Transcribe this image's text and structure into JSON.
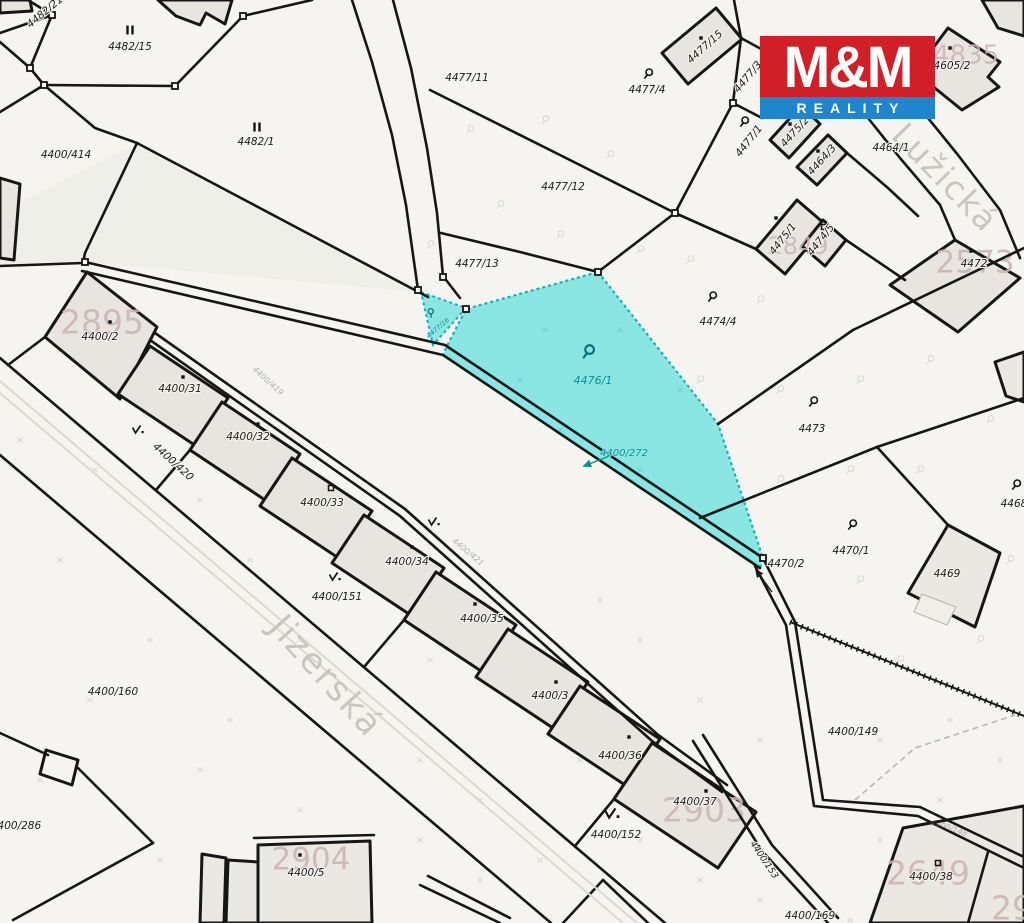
{
  "branding": {
    "logo_top": "M&M",
    "logo_bottom": "REALITY",
    "logo_red": "#d01f27",
    "logo_blue": "#1d86ce"
  },
  "highlight": {
    "fill": "#89e6e3",
    "border": "#10b2bd"
  },
  "streets": [
    {
      "name": "Jizerská",
      "x": 325,
      "y": 677,
      "rot": 48,
      "size": 35
    },
    {
      "name": "Lužická",
      "x": 944,
      "y": 179,
      "rot": 46,
      "size": 33
    }
  ],
  "parcel_labels": [
    [
      "4482/21",
      45,
      12,
      -40
    ],
    [
      "4482/15",
      130,
      47
    ],
    [
      "4482/1",
      256,
      142
    ],
    [
      "4400/414",
      66,
      155
    ],
    [
      "4477/11",
      467,
      78
    ],
    [
      "4477/4",
      647,
      90
    ],
    [
      "4477/12",
      563,
      187
    ],
    [
      "4477/13",
      477,
      264
    ],
    [
      "4477/15",
      705,
      47,
      -42
    ],
    [
      "4477/3",
      748,
      77,
      -50
    ],
    [
      "4477/1",
      749,
      141,
      -52
    ],
    [
      "4475/2",
      795,
      132,
      -48
    ],
    [
      "4464/3",
      822,
      160,
      -48
    ],
    [
      "4464/1",
      891,
      148
    ],
    [
      "4605/1",
      876,
      52
    ],
    [
      "4605/2",
      952,
      66
    ],
    [
      "4474/4",
      718,
      322
    ],
    [
      "4475/1",
      783,
      239,
      -52
    ],
    [
      "4474/5",
      821,
      240,
      -52
    ],
    [
      "4473",
      812,
      429
    ],
    [
      "4472",
      974,
      264
    ],
    [
      "4470/1",
      851,
      551
    ],
    [
      "4470/2",
      786,
      564
    ],
    [
      "4469",
      947,
      574
    ],
    [
      "4468",
      1014,
      504
    ],
    [
      "4400/2",
      100,
      337
    ],
    [
      "4400/31",
      180,
      389
    ],
    [
      "4400/32",
      248,
      437
    ],
    [
      "4400/33",
      322,
      503
    ],
    [
      "4400/34",
      407,
      562
    ],
    [
      "4400/35",
      482,
      619
    ],
    [
      "4400/3",
      550,
      696
    ],
    [
      "4400/36",
      620,
      756
    ],
    [
      "4400/37",
      695,
      802
    ],
    [
      "4400/151",
      337,
      597
    ],
    [
      "4400/152",
      616,
      835
    ],
    [
      "4400/160",
      113,
      692
    ],
    [
      "4400/286",
      16,
      826
    ],
    [
      "4400/5",
      306,
      873
    ],
    [
      "4400/149",
      853,
      732
    ],
    [
      "4400/169",
      810,
      916
    ],
    [
      "4400/38",
      931,
      877
    ],
    [
      "4400/420",
      173,
      462,
      42
    ],
    [
      "4400/153",
      764,
      860,
      56,
      9
    ]
  ],
  "highlight_labels": [
    [
      "4476/1",
      593,
      381,
      0,
      11
    ],
    [
      "4400/272",
      624,
      453,
      0,
      10
    ],
    [
      "4477/16",
      438,
      328,
      -40,
      6.5
    ]
  ],
  "faint_labels": [
    [
      "4400/419",
      268,
      381,
      42,
      8
    ],
    [
      "4400/421",
      468,
      552,
      40,
      8
    ],
    [
      "4400/148",
      949,
      828,
      18,
      8
    ]
  ],
  "building_numbers": [
    [
      "2895",
      102,
      324,
      33,
      0.88
    ],
    [
      "2903",
      704,
      812,
      33,
      0.88
    ],
    [
      "2904",
      311,
      861,
      31,
      0.88
    ],
    [
      "2649",
      928,
      875,
      33,
      0.88
    ],
    [
      "2573",
      975,
      264,
      31,
      0.88
    ],
    [
      "2849",
      798,
      247,
      24,
      0.4
    ],
    [
      "4835",
      966,
      56,
      26,
      0.5
    ],
    [
      "29",
      1012,
      910,
      33,
      0.8
    ]
  ],
  "symbols": {
    "curl_black": [
      [
        648,
        74
      ],
      [
        712,
        297
      ],
      [
        813,
        402
      ],
      [
        852,
        525
      ],
      [
        1016,
        485
      ],
      [
        744,
        122
      ]
    ],
    "curl_teal": [
      [
        588,
        352,
        1.35,
        0
      ],
      [
        431,
        313,
        0.8,
        -40
      ]
    ],
    "meadow": [
      [
        137,
        430
      ],
      [
        334,
        577
      ],
      [
        433,
        522
      ],
      [
        611,
        814,
        1.25
      ]
    ],
    "parallel": [
      [
        130,
        30
      ],
      [
        257,
        127
      ]
    ],
    "dots": [
      [
        110,
        322
      ],
      [
        183,
        377
      ],
      [
        258,
        424
      ],
      [
        412,
        547
      ],
      [
        475,
        604
      ],
      [
        556,
        682
      ],
      [
        629,
        737
      ],
      [
        706,
        791
      ],
      [
        701,
        38
      ],
      [
        790,
        124
      ],
      [
        818,
        151
      ],
      [
        776,
        218
      ],
      [
        950,
        48
      ],
      [
        971,
        251
      ],
      [
        300,
        855
      ]
    ],
    "squares": [
      [
        331,
        488
      ],
      [
        824,
        227
      ],
      [
        938,
        863
      ]
    ],
    "vertices": [
      [
        52,
        15
      ],
      [
        30,
        68
      ],
      [
        44,
        85
      ],
      [
        175,
        86
      ],
      [
        243,
        16
      ],
      [
        733,
        103
      ],
      [
        675,
        213
      ],
      [
        418,
        290
      ],
      [
        443,
        277
      ],
      [
        598,
        272
      ],
      [
        85,
        262
      ],
      [
        466,
        309
      ],
      [
        763,
        558
      ]
    ]
  },
  "arrows": [
    {
      "from": [
        612,
        455
      ],
      "to": [
        584,
        466
      ],
      "color": "#0e8c96"
    },
    {
      "from": [
        772,
        592
      ],
      "to": [
        756,
        570
      ],
      "color": "#1b1b1b"
    }
  ]
}
